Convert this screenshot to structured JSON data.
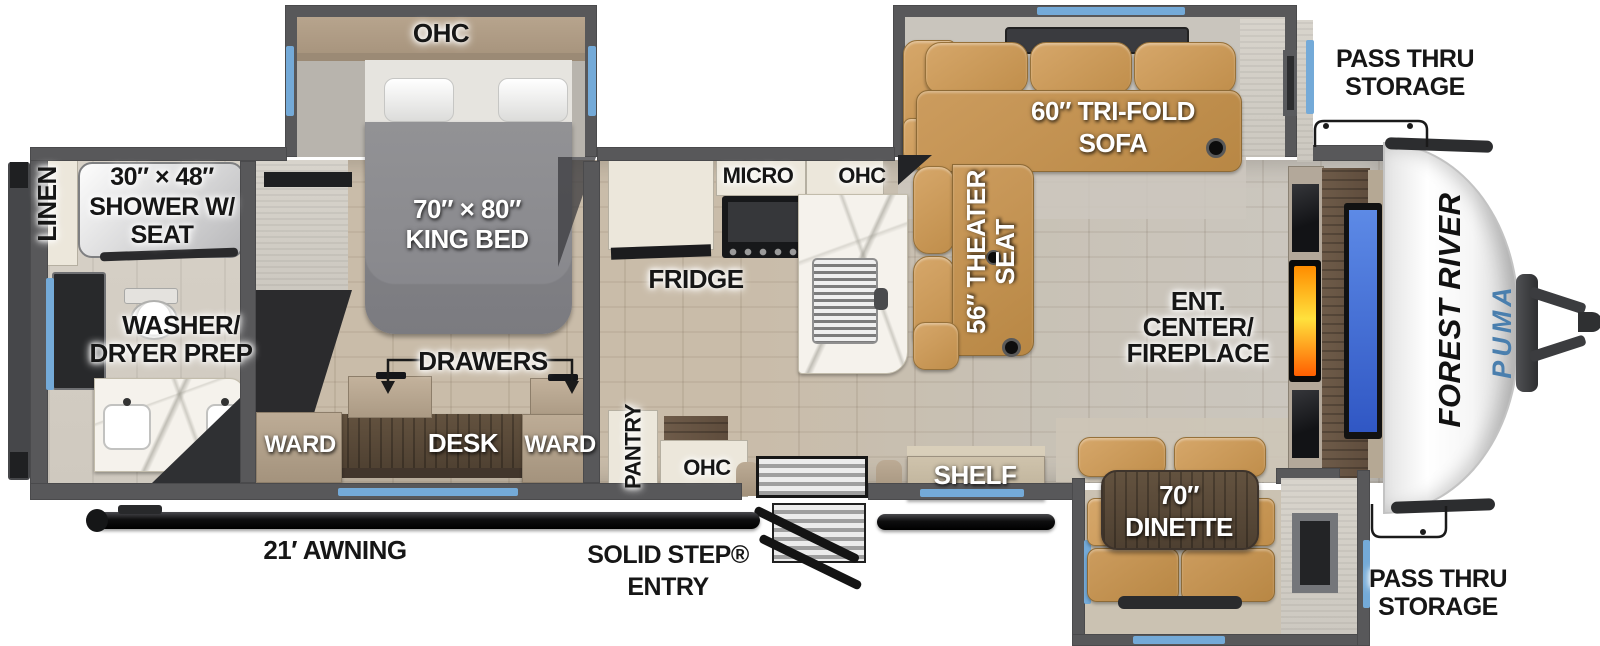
{
  "colors": {
    "wall": "#58585a",
    "window_accent": "#74aad8",
    "sofa_tan": "#c9995c",
    "fireplace_orange": "#ff7a00",
    "tv_blue": "#3f6cd8",
    "brand_blue": "#4a7fae",
    "cap_white": "#ffffff"
  },
  "bath": {
    "linen": "LINEN",
    "shower1": "30″ × 48″",
    "shower2": "SHOWER W/",
    "shower3": "SEAT",
    "washer1": "WASHER/",
    "washer2": "DRYER PREP"
  },
  "bedroom": {
    "ohc": "OHC",
    "bed1": "70″ × 80″",
    "bed2": "KING BED",
    "drawers": "DRAWERS",
    "ward_left": "WARD",
    "desk": "DESK",
    "ward_right": "WARD"
  },
  "kitchen": {
    "fridge": "FRIDGE",
    "micro": "MICRO",
    "ohc_upper": "OHC",
    "pantry": "PANTRY",
    "ohc_lower": "OHC"
  },
  "living": {
    "sofa1": "60″ TRI-FOLD",
    "sofa2": "SOFA",
    "theater1": "56″ THEATER",
    "theater2": "SEAT",
    "ent1": "ENT.",
    "ent2": "CENTER/",
    "ent3": "FIREPLACE",
    "shelf": "SHELF"
  },
  "dinette": {
    "size": "70″",
    "name": "DINETTE"
  },
  "exterior": {
    "pass_top1": "PASS THRU",
    "pass_top2": "STORAGE",
    "pass_bottom1": "PASS THRU",
    "pass_bottom2": "STORAGE",
    "awning": "21′ AWNING",
    "entry1": "SOLID STEP®",
    "entry2": "ENTRY",
    "brand": "FOREST RIVER",
    "model": "PUMA"
  }
}
